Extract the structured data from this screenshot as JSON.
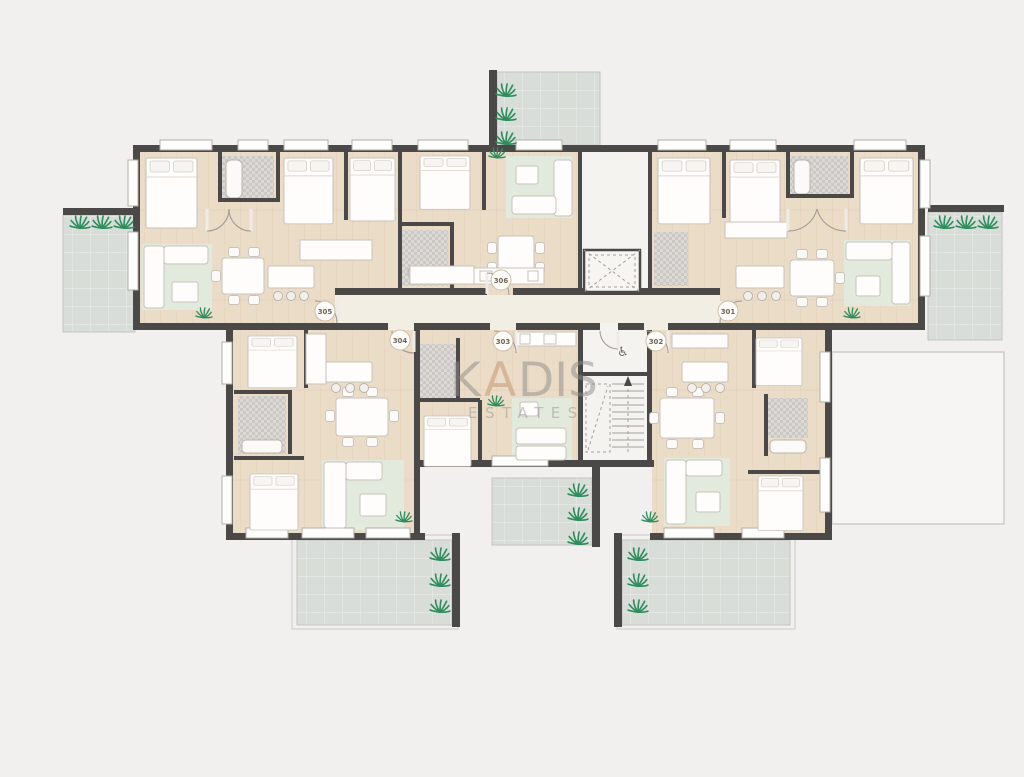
{
  "watermark": {
    "part1": "K",
    "part2": "A",
    "part3": "DIS",
    "line2": "ESTATES"
  },
  "units": {
    "u301": {
      "label": "301"
    },
    "u302": {
      "label": "302"
    },
    "u303": {
      "label": "303"
    },
    "u304": {
      "label": "304"
    },
    "u305": {
      "label": "305"
    },
    "u306": {
      "label": "306"
    }
  },
  "icons": {
    "wheelchair": "♿",
    "plant": "palm-plant-icon",
    "elevator": "elevator-shaft-x",
    "stairs": "staircase-treads-arrow"
  },
  "colors": {
    "background": "#f1f0ee",
    "wall": "#4b4947",
    "wood_floor": "#ebdcc8",
    "corridor_floor": "#f3eee3",
    "core_floor": "#f5f3f0",
    "balcony_tile": "#d9ddd8",
    "bath_tile": "#dbd8d5",
    "rug": "#e2e9dd",
    "plant": "#2f8e5f",
    "furniture": "#fefdfc",
    "watermark_gray": "#8e8c8a",
    "watermark_accent": "#c09467"
  }
}
